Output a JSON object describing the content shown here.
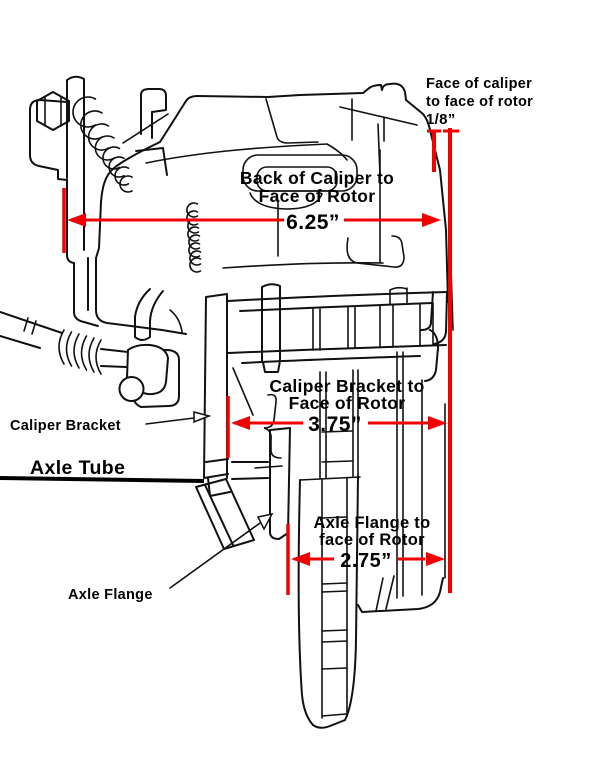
{
  "colors": {
    "background": "#ffffff",
    "line_art": "#111111",
    "dimension_red": "#f10000",
    "label_text": "#000000"
  },
  "dimensions": {
    "caliper_face": {
      "line1": "Face of caliper",
      "line2": "to face of rotor",
      "value": "1/8”"
    },
    "back_of_caliper": {
      "line1": "Back of Caliper to",
      "line2": "Face of Rotor",
      "value": "6.25”"
    },
    "caliper_bracket": {
      "line1": "Caliper Bracket to",
      "line2": "Face of Rotor",
      "value": "3.75”"
    },
    "axle_flange": {
      "line1": "Axle Flange to",
      "line2": "face of Rotor",
      "value": "2.75”"
    }
  },
  "part_labels": {
    "caliper_bracket": "Caliper Bracket",
    "axle_tube": "Axle Tube",
    "axle_flange": "Axle Flange"
  }
}
